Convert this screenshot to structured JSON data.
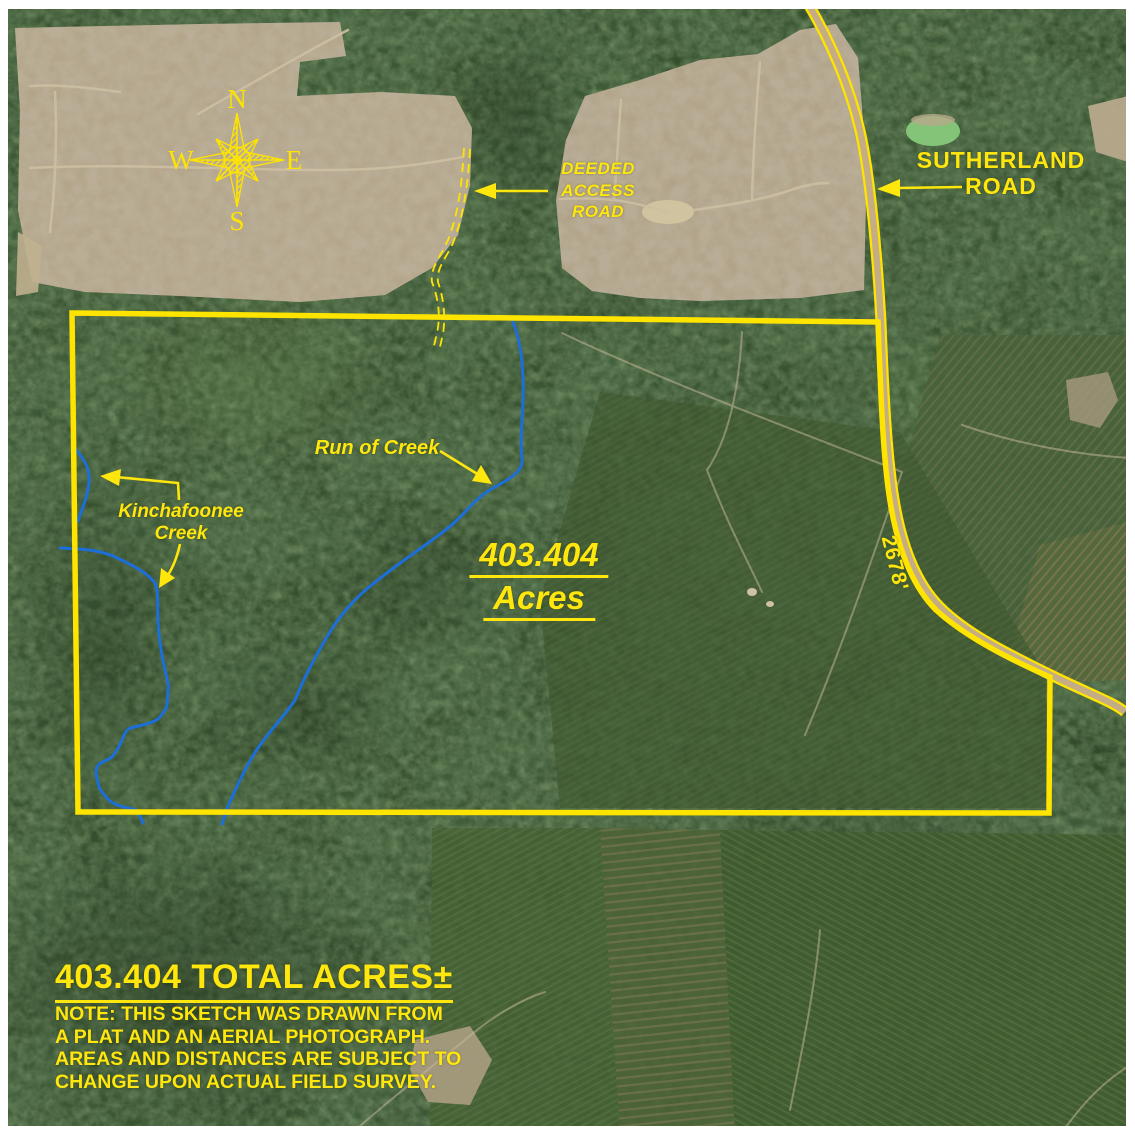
{
  "map": {
    "compass": {
      "north": "N",
      "east": "E",
      "south": "S",
      "west": "W"
    },
    "annotations": {
      "deeded_access_road": [
        "DEEDED",
        "ACCESS",
        "ROAD"
      ],
      "sutherland_road": [
        "SUTHERLAND",
        "ROAD"
      ],
      "run_of_creek": "Run of Creek",
      "kinchafoonee_creek": [
        "Kinchafoonee",
        "Creek"
      ],
      "center_acreage_value": "403.404",
      "center_acreage_unit": "Acres",
      "road_frontage_distance": "2678'"
    },
    "footer": {
      "total_acres_title": "403.404 TOTAL ACRES±",
      "note_lines": [
        "NOTE: THIS SKETCH WAS DRAWN FROM",
        "A PLAT AND AN AERIAL PHOTOGRAPH.",
        "AREAS AND DISTANCES ARE SUBJECT TO",
        "CHANGE UPON ACTUAL FIELD SURVEY."
      ]
    },
    "colors": {
      "annotation_yellow": "#ffe60d",
      "boundary_yellow": "#ffe400",
      "creek_blue": "#1c6ed8"
    }
  }
}
